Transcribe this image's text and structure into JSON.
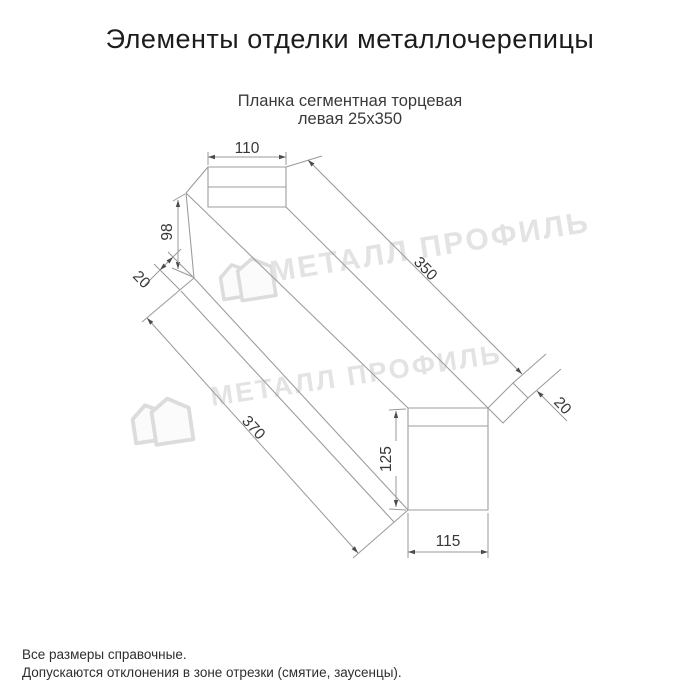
{
  "window": {
    "title": "Элементы отделки металлочерепицы"
  },
  "product": {
    "name_line1": "Планка сегментная торцевая",
    "name_line2": "левая 25x350"
  },
  "drawing": {
    "type": "dimensioned technical drawing of left segmental end strip 25x350",
    "dimensions": {
      "top_width": "110",
      "side_height": "98",
      "near_fold": "20",
      "edge_length": "350",
      "total_length": "370",
      "far_fold": "20",
      "far_height": "125",
      "far_width": "115"
    },
    "watermark_text": "МЕТАЛЛ ПРОФИЛЬ"
  },
  "footer": {
    "note1": "Все размеры справочные.",
    "note2": "Допускаются отклонения в зоне отрезки (смятие, заусенцы)."
  },
  "colors": {
    "background": "#ffffff",
    "title_text": "#1c1c1c",
    "subtitle_text": "#3a3a3a",
    "drawing_lines": "#9d9d9d",
    "dimension_text": "#383838",
    "watermark": "#e3e3e3"
  }
}
